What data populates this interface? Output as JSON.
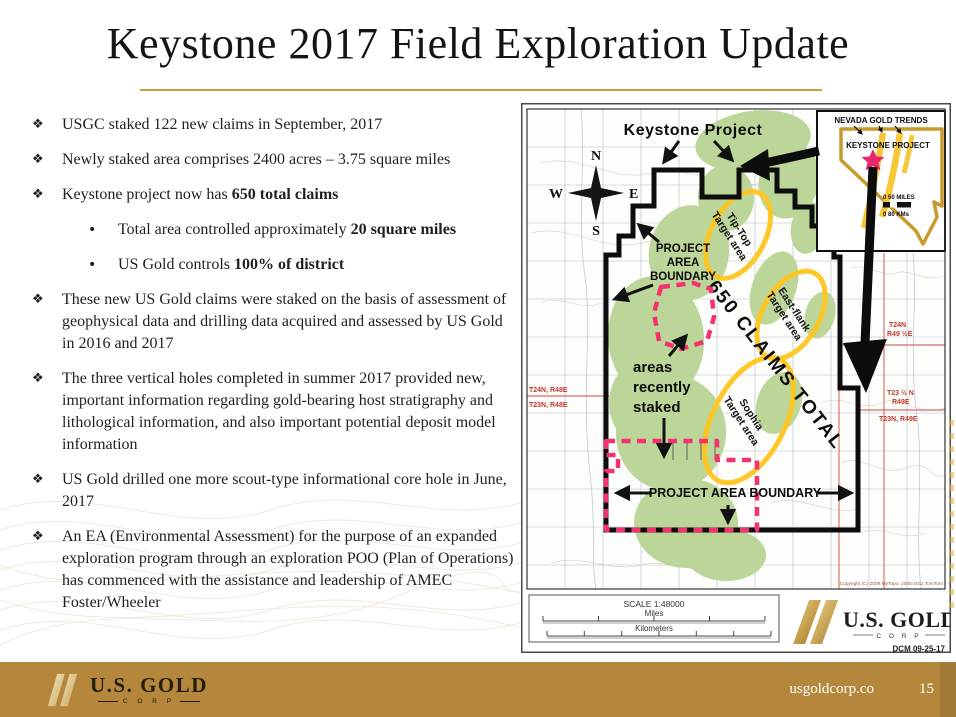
{
  "slide": {
    "title": "Keystone 2017 Field Exploration Update"
  },
  "glyphs": {
    "diamond": "❖",
    "dot": "•"
  },
  "bullets": [
    {
      "text": "USGC staked 122 new claims in September, 2017",
      "bold": ""
    },
    {
      "text": "Newly staked area comprises 2400 acres – 3.75 square miles",
      "bold": ""
    },
    {
      "text": "Keystone project now has ",
      "bold": "650 total claims"
    },
    {
      "text": "These new US Gold claims were staked on the basis of assessment of geophysical data and drilling data acquired and assessed by US Gold in 2016 and 2017",
      "bold": ""
    },
    {
      "text": "The three vertical holes completed in summer 2017 provided new, important information regarding gold-bearing host stratigraphy and lithological information, and also important potential deposit model information",
      "bold": ""
    },
    {
      "text": "US Gold drilled one more scout-type informational core hole in June, 2017",
      "bold": ""
    },
    {
      "text": "An EA (Environmental Assessment) for the purpose of an expanded exploration program through an exploration POO (Plan of Operations) has commenced with the assistance and leadership of AMEC Foster/Wheeler",
      "bold": ""
    }
  ],
  "sub_bullets": [
    {
      "text": "Total area controlled approximately ",
      "bold": "20 square miles"
    },
    {
      "text": "US Gold controls ",
      "bold": "100% of district"
    }
  ],
  "map": {
    "title": "Keystone Project",
    "compass": {
      "n": "N",
      "e": "E",
      "s": "S",
      "w": "W"
    },
    "boundary_upper_lines": [
      "PROJECT",
      "AREA",
      "BOUNDARY"
    ],
    "boundary_lower": "PROJECT AREA BOUNDARY",
    "claims_total": "650 CLAIMS TOTAL",
    "staked_lines": [
      "areas",
      "recently",
      "staked"
    ],
    "targets": {
      "tip_top": [
        "Tip-Top",
        "Target area"
      ],
      "east_flank": [
        "East-flank",
        "Target area"
      ],
      "sophia": [
        "Sophia",
        "Target area"
      ]
    },
    "townships": {
      "left_upper": "T24N, R48E",
      "left_lower": "T23N, R48E",
      "right_upper": [
        "T24N",
        "R49 ½E"
      ],
      "right_mid": [
        "T23 ½ N",
        "R49E"
      ],
      "right_lower": "T23N, R49E"
    },
    "inset": {
      "title": "NEVADA GOLD TRENDS",
      "label": "KEYSTONE PROJECT",
      "scale_miles": "0    50 MILES",
      "scale_km": "0    80 KMs"
    },
    "scalebar": {
      "scale": "SCALE 1:48000",
      "miles": "Miles",
      "kilometers": "Kilometers"
    },
    "copyright": "Copyright (C) 2009 MyTopo, 2005-2011 TomTom",
    "logo": {
      "name": "U.S. GOLD",
      "corp": "C O R P"
    },
    "date_code": "DCM  09-25-17"
  },
  "footer": {
    "logo_name": "U.S. GOLD",
    "logo_corp": "C O R P",
    "website": "usgoldcorp.co",
    "page_number": "15"
  },
  "colors": {
    "footer_gold": "#B5873D",
    "title_underline": "#C8A03A",
    "boundary_black": "#0D0D0D",
    "staked_pink": "#F2336F",
    "target_yellow": "#FFC61E",
    "map_green": "#BCD69A",
    "township_red": "#C6392C",
    "nevada_gold": "#C79A2E",
    "star_pink": "#E8256F"
  }
}
